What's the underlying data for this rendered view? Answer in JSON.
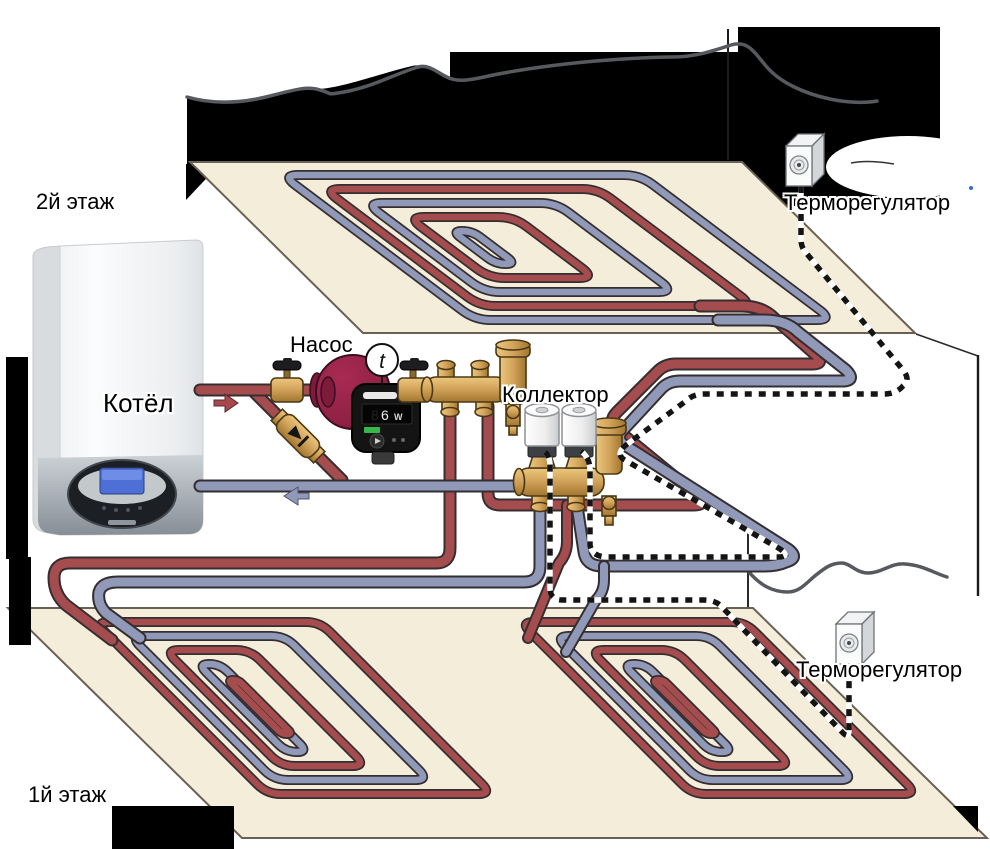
{
  "labels": {
    "floor2": "2й этаж",
    "boiler": "Котёл",
    "pump": "Насос",
    "collector": "Коллектор",
    "thermostat_floor2": "Терморегулятор",
    "thermostat_floor1": "Терморегулятор",
    "floor1": "1й этаж",
    "thermometer": "t"
  },
  "pump_display": {
    "value": "6",
    "unit": "W"
  },
  "colors": {
    "supply_pipe": "#a54c4f",
    "return_pipe": "#9099b7",
    "floor_panel": "#f4edda",
    "panel_edge": "#6a6154",
    "brass": "#d3a45c",
    "pump_body": "#8e2144",
    "wall_silhouette": "#000000",
    "sketch_line": "#565a5f",
    "display_green": "#37b84a"
  }
}
